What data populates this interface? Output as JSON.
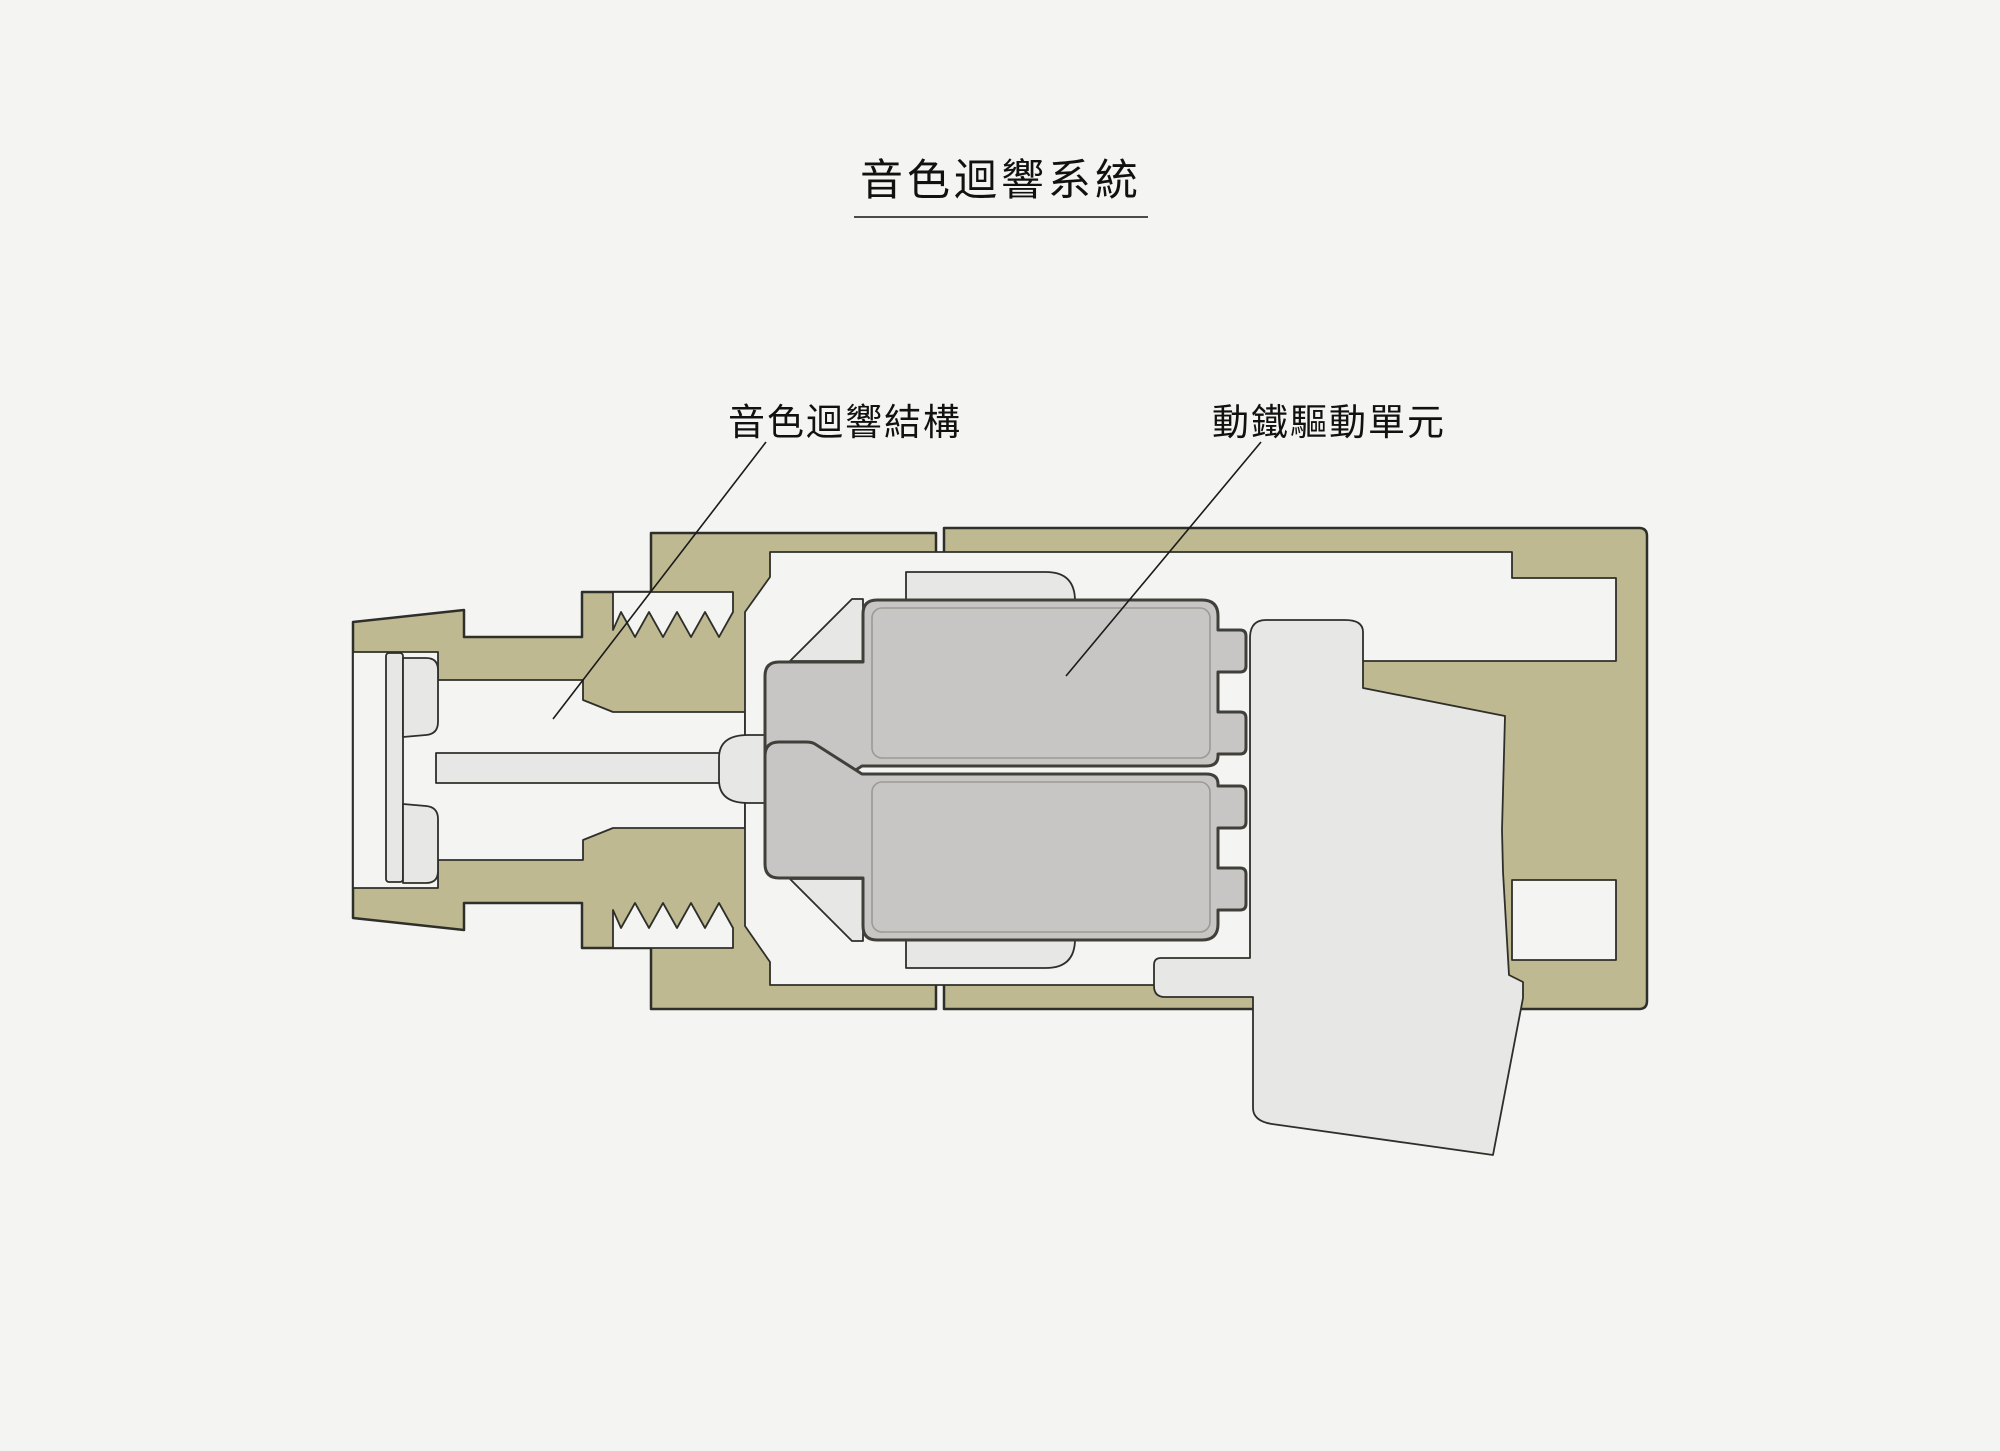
{
  "title": {
    "text": "音色迴響系統"
  },
  "labels": [
    {
      "id": "resonance-structure",
      "text": "音色迴響結構"
    },
    {
      "id": "ba-driver-unit",
      "text": "動鐵驅動單元"
    }
  ],
  "colors": {
    "background": "#f4f4f2",
    "housing": "#bfb992",
    "component_light": "#e7e7e5",
    "driver": "#c7c6c4",
    "outline": "#2f2f2a",
    "driver_outline": "#413f39",
    "driver_rim": "#9b9a93",
    "leader_line": "#1a1a1a",
    "text": "#111111"
  },
  "parts": [
    "threaded-nozzle-housing",
    "mesh-plate",
    "sound-tube",
    "tube-funnel",
    "ba-driver-top",
    "ba-driver-bottom",
    "driver-holder",
    "rear-cavity-block"
  ]
}
